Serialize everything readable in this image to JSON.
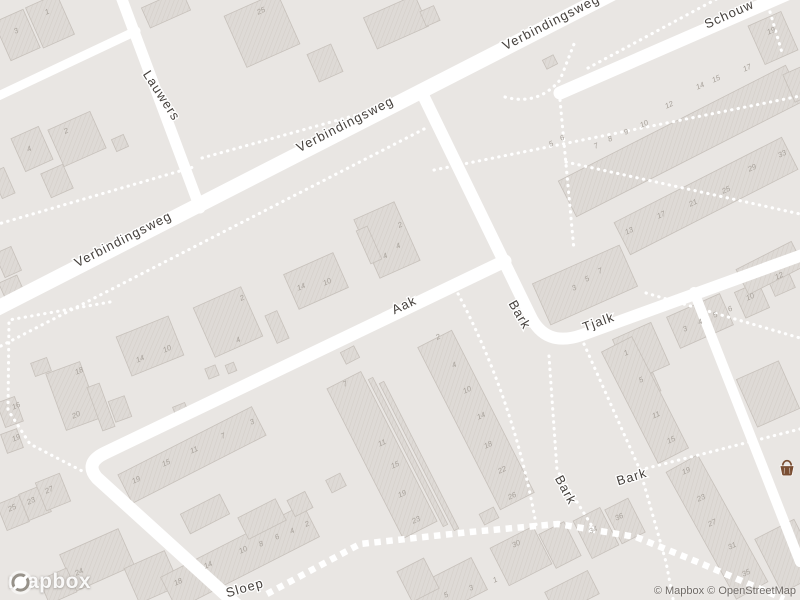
{
  "map": {
    "provider_logo": "mapbox",
    "attribution": "© Mapbox © OpenStreetMap",
    "colors": {
      "background": "#e9e6e3",
      "road": "#ffffff",
      "building_fill": "#dedad6",
      "building_hatch": "#d3cec8",
      "building_outline": "#c7c1bb",
      "street_label": "#45403c",
      "house_number": "#a8a29b",
      "poi_basket": "#7a4e33"
    },
    "poi": {
      "icon": "grocery-basket-icon",
      "x": 787,
      "y": 469
    },
    "street_labels": [
      {
        "name": "Verbindingsweg",
        "x": 125,
        "y": 243,
        "rot": -27
      },
      {
        "name": "Verbindingsweg",
        "x": 347,
        "y": 128,
        "rot": -27
      },
      {
        "name": "Verbindingsweg",
        "x": 553,
        "y": 26,
        "rot": -27
      },
      {
        "name": "Lauwers",
        "x": 158,
        "y": 98,
        "rot": 57
      },
      {
        "name": "Schouw",
        "x": 731,
        "y": 18,
        "rot": -24
      },
      {
        "name": "Aak",
        "x": 406,
        "y": 309,
        "rot": -25
      },
      {
        "name": "Bark",
        "x": 516,
        "y": 317,
        "rot": 60
      },
      {
        "name": "Tjalk",
        "x": 600,
        "y": 326,
        "rot": -20
      },
      {
        "name": "Bark",
        "x": 562,
        "y": 492,
        "rot": 62
      },
      {
        "name": "Bark",
        "x": 633,
        "y": 481,
        "rot": -17
      },
      {
        "name": "Sloep",
        "x": 246,
        "y": 592,
        "rot": -16
      }
    ],
    "house_numbers": [
      [
        "3",
        17,
        33
      ],
      [
        "1",
        48,
        14
      ],
      [
        "2",
        67,
        133
      ],
      [
        "4",
        30,
        151
      ],
      [
        "16",
        17,
        408
      ],
      [
        "19",
        17,
        440
      ],
      [
        "25",
        262,
        13
      ],
      [
        "2",
        401,
        227
      ],
      [
        "4",
        399,
        248
      ],
      [
        "4",
        386,
        258
      ],
      [
        "14",
        302,
        289
      ],
      [
        "10",
        328,
        284
      ],
      [
        "14",
        141,
        361
      ],
      [
        "10",
        168,
        351
      ],
      [
        "2",
        243,
        300
      ],
      [
        "4",
        239,
        342
      ],
      [
        "18",
        80,
        373
      ],
      [
        "20",
        77,
        417
      ],
      [
        "25",
        13,
        510
      ],
      [
        "23",
        32,
        503
      ],
      [
        "27",
        50,
        492
      ],
      [
        "24",
        80,
        574
      ],
      [
        "19",
        137,
        482
      ],
      [
        "15",
        167,
        465
      ],
      [
        "11",
        195,
        452
      ],
      [
        "7",
        224,
        438
      ],
      [
        "3",
        253,
        424
      ],
      [
        "18",
        179,
        584
      ],
      [
        "14",
        209,
        567
      ],
      [
        "10",
        244,
        552
      ],
      [
        "8",
        262,
        546
      ],
      [
        "6",
        278,
        539
      ],
      [
        "4",
        293,
        533
      ],
      [
        "2",
        308,
        526
      ],
      [
        "7",
        346,
        386
      ],
      [
        "11",
        383,
        445
      ],
      [
        "15",
        396,
        467
      ],
      [
        "19",
        403,
        496
      ],
      [
        "23",
        417,
        522
      ],
      [
        "2",
        439,
        339
      ],
      [
        "4",
        455,
        367
      ],
      [
        "10",
        468,
        392
      ],
      [
        "14",
        482,
        418
      ],
      [
        "18",
        489,
        447
      ],
      [
        "22",
        503,
        472
      ],
      [
        "26",
        513,
        498
      ],
      [
        "3",
        575,
        290
      ],
      [
        "5",
        588,
        281
      ],
      [
        "7",
        601,
        273
      ],
      [
        "1",
        627,
        355
      ],
      [
        "5",
        642,
        382
      ],
      [
        "3",
        686,
        331
      ],
      [
        "4",
        701,
        324
      ],
      [
        "5",
        716,
        317
      ],
      [
        "6",
        731,
        311
      ],
      [
        "10",
        751,
        299
      ],
      [
        "12",
        780,
        278
      ],
      [
        "11",
        657,
        417
      ],
      [
        "15",
        672,
        442
      ],
      [
        "19",
        687,
        473
      ],
      [
        "23",
        702,
        500
      ],
      [
        "27",
        713,
        525
      ],
      [
        "31",
        733,
        548
      ],
      [
        "35",
        747,
        575
      ],
      [
        "5",
        552,
        146
      ],
      [
        "6",
        563,
        140
      ],
      [
        "7",
        597,
        148
      ],
      [
        "8",
        611,
        141
      ],
      [
        "9",
        627,
        134
      ],
      [
        "10",
        645,
        126
      ],
      [
        "12",
        670,
        107
      ],
      [
        "14",
        701,
        88
      ],
      [
        "15",
        717,
        81
      ],
      [
        "17",
        748,
        70
      ],
      [
        "19",
        772,
        33
      ],
      [
        "13",
        630,
        233
      ],
      [
        "17",
        662,
        217
      ],
      [
        "21",
        694,
        205
      ],
      [
        "25",
        727,
        192
      ],
      [
        "29",
        753,
        170
      ],
      [
        "33",
        783,
        156
      ],
      [
        "30",
        517,
        546
      ],
      [
        "34",
        594,
        532
      ],
      [
        "36",
        620,
        519
      ],
      [
        "5",
        447,
        597
      ],
      [
        "3",
        472,
        590
      ],
      [
        "1",
        496,
        582
      ]
    ],
    "roads": [
      {
        "d": "M -10,312 L 615,-8",
        "w": 15
      },
      {
        "d": "M 560,93 L 808,-15",
        "w": 13
      },
      {
        "d": "M 120,-6 L 200,208",
        "w": 11
      },
      {
        "d": "M -6,98 L 136,31",
        "w": 9
      },
      {
        "d": "M 505,261 L 105,453 Q 84,463 97,478 L 238,606",
        "w": 13
      },
      {
        "d": "M 421,91 L 530,315 Q 545,348 582,335 L 808,253",
        "w": 12
      },
      {
        "d": "M 694,292 L 800,562",
        "w": 10
      }
    ],
    "paths_dotted": [
      "M -5,349 L 428,127",
      "M -5,225 L 197,166",
      "M 202,158 L 428,95",
      "M 434,170 L 800,96",
      "M 505,97 Q 538,106 560,80 L 574,44",
      "M 588,68 L 724,-5",
      "M 770,12 L 783,56",
      "M 560,100 L 574,250",
      "M 566,162 L 800,214",
      "M 646,293 L 800,338",
      "M 584,344 L 640,470 L 666,562 L 674,604",
      "M 640,470 L 800,429",
      "M 549,356 L 557,470 L 592,526",
      "M 455,288 Q 515,400 537,530",
      "M 110,302 L 9,320 L 8,410 L 30,444 L 84,472"
    ],
    "paths_crossing": [
      "M 267,594 L 360,544 L 470,532 L 558,524 L 636,537 L 700,563 L 784,599"
    ],
    "buildings": [
      [
        17,
        35,
        32,
        42,
        -24
      ],
      [
        50,
        21,
        34,
        44,
        -24
      ],
      [
        166,
        9,
        44,
        22,
        -24
      ],
      [
        8,
        262,
        18,
        26,
        -24
      ],
      [
        13,
        291,
        20,
        26,
        -24
      ],
      [
        77,
        139,
        46,
        40,
        -24
      ],
      [
        32,
        149,
        30,
        36,
        -24
      ],
      [
        120,
        143,
        13,
        13,
        -24
      ],
      [
        57,
        181,
        24,
        26,
        -24
      ],
      [
        3,
        183,
        14,
        28,
        -24
      ],
      [
        262,
        30,
        58,
        56,
        -24
      ],
      [
        396,
        22,
        56,
        34,
        -24
      ],
      [
        430,
        16,
        15,
        16,
        -24
      ],
      [
        325,
        63,
        26,
        30,
        -24
      ],
      [
        550,
        62,
        12,
        10,
        -27
      ],
      [
        387,
        240,
        44,
        64,
        -24
      ],
      [
        369,
        245,
        12,
        36,
        -24
      ],
      [
        316,
        281,
        54,
        38,
        -24
      ],
      [
        150,
        346,
        56,
        42,
        -22
      ],
      [
        228,
        322,
        52,
        54,
        -24
      ],
      [
        277,
        327,
        13,
        30,
        -24
      ],
      [
        181,
        411,
        13,
        13,
        -22
      ],
      [
        212,
        372,
        11,
        11,
        -22
      ],
      [
        231,
        368,
        9,
        9,
        -22
      ],
      [
        73,
        396,
        36,
        60,
        -20
      ],
      [
        101,
        407,
        13,
        46,
        -20
      ],
      [
        120,
        409,
        17,
        22,
        -20
      ],
      [
        41,
        367,
        17,
        14,
        -20
      ],
      [
        10,
        412,
        19,
        26,
        -20
      ],
      [
        12,
        441,
        17,
        20,
        -20
      ],
      [
        13,
        513,
        24,
        28,
        -22
      ],
      [
        35,
        503,
        24,
        28,
        -22
      ],
      [
        53,
        492,
        26,
        30,
        -22
      ],
      [
        97,
        560,
        64,
        40,
        -24
      ],
      [
        58,
        586,
        30,
        26,
        -24
      ],
      [
        152,
        577,
        44,
        38,
        -24
      ],
      [
        192,
        455,
        150,
        32,
        -27
      ],
      [
        240,
        557,
        160,
        36,
        -27
      ],
      [
        382,
        455,
        38,
        168,
        -27
      ],
      [
        476,
        420,
        38,
        182,
        -27
      ],
      [
        408,
        452,
        5,
        165,
        -27
      ],
      [
        419,
        456,
        5,
        165,
        -27
      ],
      [
        262,
        519,
        42,
        24,
        -27
      ],
      [
        300,
        504,
        20,
        18,
        -27
      ],
      [
        205,
        514,
        44,
        22,
        -27
      ],
      [
        336,
        483,
        16,
        14,
        -27
      ],
      [
        350,
        355,
        15,
        13,
        -27
      ],
      [
        585,
        285,
        95,
        45,
        -24
      ],
      [
        641,
        352,
        42,
        46,
        -24
      ],
      [
        645,
        387,
        26,
        20,
        -24
      ],
      [
        700,
        321,
        58,
        34,
        -24
      ],
      [
        752,
        300,
        26,
        28,
        -24
      ],
      [
        780,
        280,
        22,
        26,
        -24
      ],
      [
        645,
        400,
        34,
        125,
        -27
      ],
      [
        717,
        527,
        36,
        145,
        -29
      ],
      [
        768,
        394,
        46,
        52,
        -24
      ],
      [
        788,
        556,
        44,
        60,
        -27
      ],
      [
        521,
        556,
        48,
        42,
        -27
      ],
      [
        560,
        545,
        28,
        38,
        -27
      ],
      [
        596,
        533,
        30,
        42,
        -27
      ],
      [
        625,
        521,
        26,
        38,
        -27
      ],
      [
        449,
        589,
        68,
        36,
        -27
      ],
      [
        418,
        580,
        30,
        34,
        -27
      ],
      [
        572,
        593,
        48,
        26,
        -27
      ],
      [
        489,
        516,
        16,
        12,
        -27
      ],
      [
        681,
        141,
        255,
        40,
        -27
      ],
      [
        706,
        196,
        188,
        36,
        -27
      ],
      [
        770,
        268,
        62,
        28,
        -27
      ],
      [
        773,
        38,
        36,
        42,
        -24
      ],
      [
        799,
        84,
        22,
        30,
        -24
      ]
    ]
  }
}
